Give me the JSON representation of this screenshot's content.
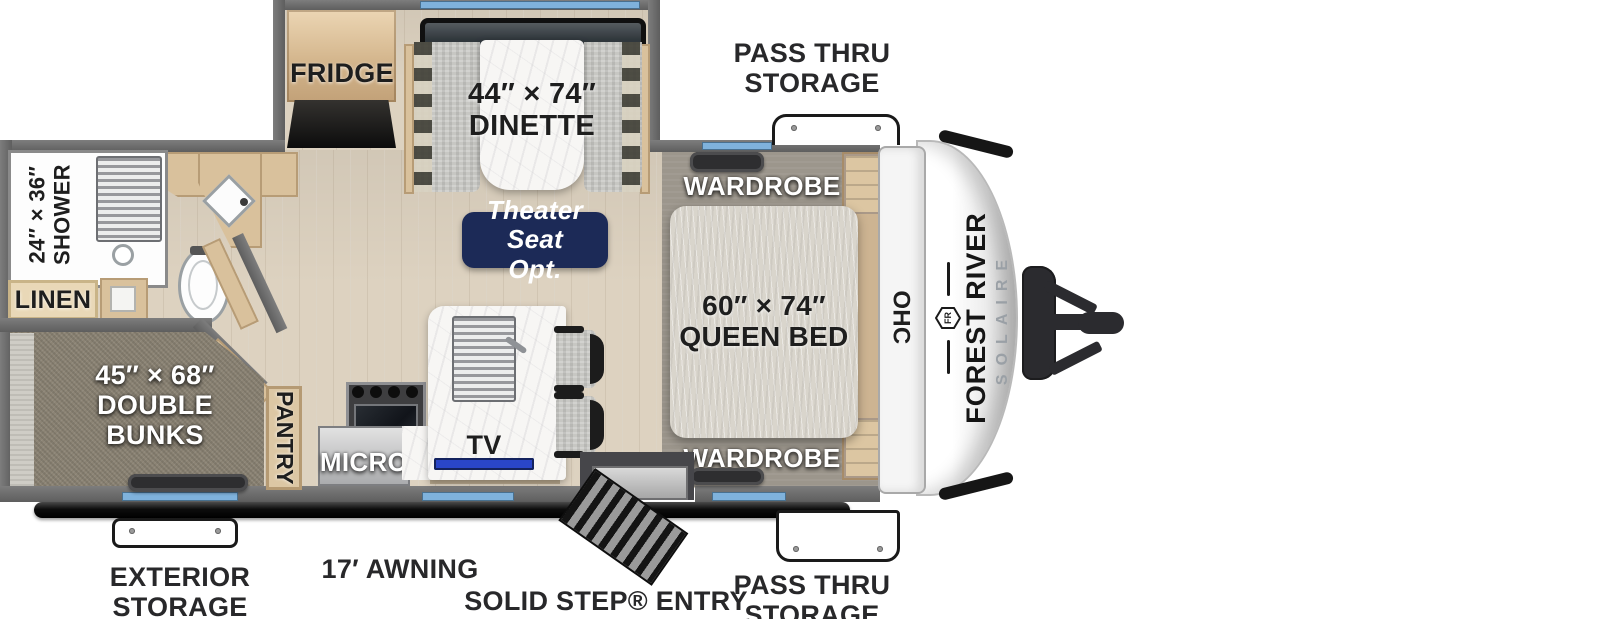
{
  "floorplan": {
    "title": "Forest River Solaire travel trailer floor plan",
    "brand": {
      "make": "FOREST RIVER",
      "model": "SOLAIRE",
      "monogram": "FR"
    },
    "areas": {
      "fridge": "FRIDGE",
      "dinette": "44″ × 74″\nDINETTE",
      "theater_seat": "Theater Seat\nOpt.",
      "shower": "24″ × 36″\nSHOWER",
      "linen": "LINEN",
      "double_bunks": "45″ × 68″\nDOUBLE\nBUNKS",
      "pantry": "PANTRY",
      "micro": "MICRO",
      "tv": "TV",
      "wardrobe_top": "WARDROBE",
      "wardrobe_bottom": "WARDROBE",
      "queen_bed": "60″ × 74″\nQUEEN BED",
      "ohc": "OHC"
    },
    "exterior": {
      "pass_thru_storage_top": "PASS THRU\nSTORAGE",
      "pass_thru_storage_bottom": "PASS THRU\nSTORAGE",
      "solid_step_entry": "SOLID STEP® ENTRY",
      "awning": "17′ AWNING",
      "exterior_storage": "EXTERIOR\nSTORAGE"
    },
    "colors": {
      "accent_navy": "#1c2a57",
      "window_blue": "#7fb2dc",
      "wall_gray": "#6e6e6e",
      "floor_tan": "#ddd2c0",
      "bunk_taupe": "#8b8374"
    }
  }
}
